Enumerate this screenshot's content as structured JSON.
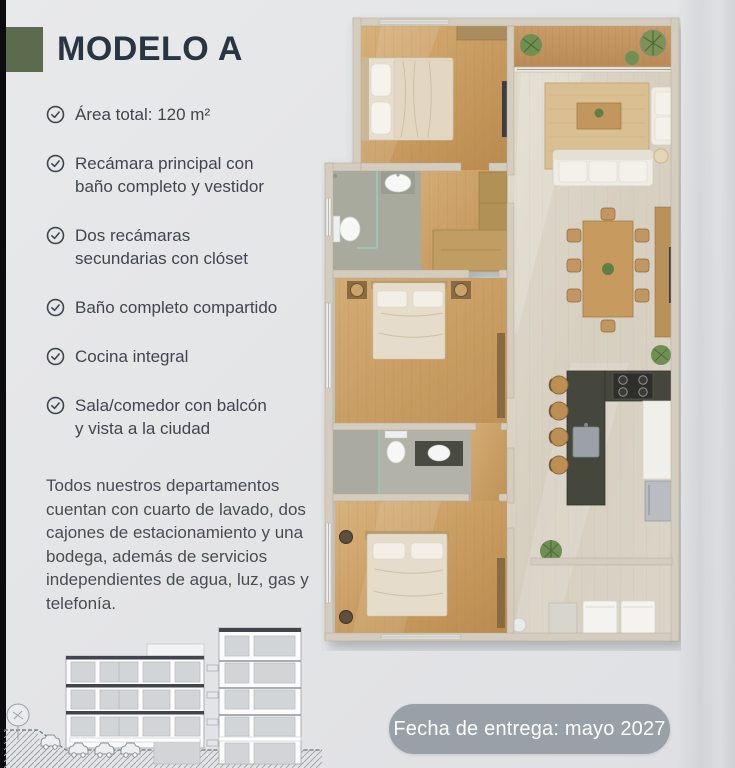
{
  "colors": {
    "background": "#e4e5e7",
    "accent_green": "#5c6b4d",
    "title": "#2b3541",
    "body_text": "#3f464f",
    "badge_bg": "#9aa0a8",
    "badge_text": "#fdfdfd"
  },
  "header": {
    "title": "MODELO A"
  },
  "features": [
    "Área total: 120 m²",
    "Recámara principal con baño completo y vestidor",
    "Dos recámaras secundarias con clóset",
    "Baño completo compartido",
    "Cocina integral",
    "Sala/comedor con balcón y vista a la ciudad"
  ],
  "description": "Todos nuestros departamentos cuentan con cuarto de lavado, dos cajones de estacionamiento y una bodega, además de servicios independientes de agua, luz, gas y telefonía.",
  "delivery_badge": {
    "label": "Fecha de entrega: mayo 2027"
  },
  "floor_plan": {
    "rooms": [
      "recamara-principal",
      "bano-principal",
      "vestidor",
      "recamara-secundaria-1",
      "bano-compartido",
      "recamara-secundaria-2",
      "balcon",
      "sala",
      "comedor",
      "cocina",
      "cuarto-de-lavado"
    ]
  },
  "elevation": {
    "kind": "building-elevation-sketch"
  }
}
